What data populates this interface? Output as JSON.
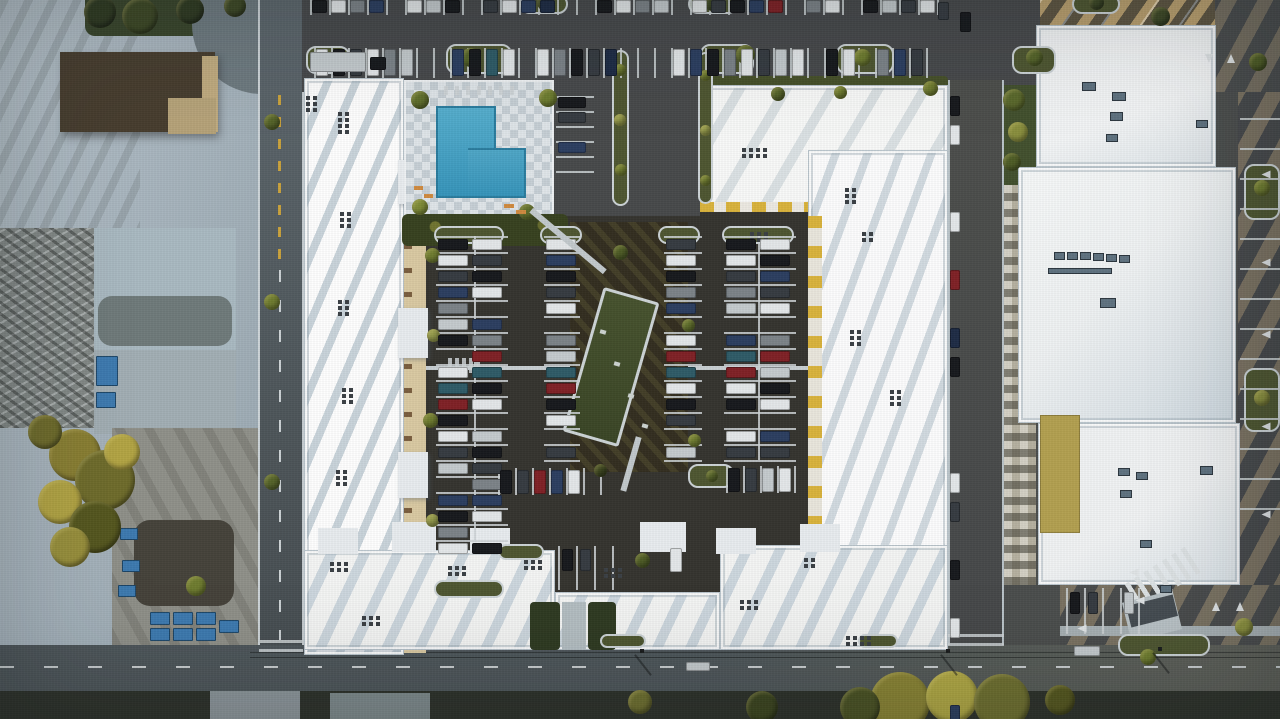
{
  "meta": {
    "description": "Top-down aerial drone photograph at golden hour: a large white-roofed apartment complex surrounding an interior courtyard parking lot full of cars, with a swimming pool and checkerboard deck at the upper left of the courtyard, a white commercial building to the east, industrial gray buildings and dirt lots to the west, and streets with long palm-tree shadows on the right and bottom edges.",
    "scene_type": "aerial-photograph",
    "lighting": "low evening sun from the upper right, long diagonal shadows"
  },
  "palette": {
    "asphalt_lot": "#47494a",
    "asphalt_courtyard": "#35342f",
    "road": "#525a5f",
    "concrete": "#aeb9c1",
    "roof_white": "#e9edf0",
    "roof_shadow": "#cdd8e0",
    "sun_warm": "#d6b274",
    "pool_water": "#3f9ec3",
    "pool_deck": "#dfe5e9",
    "tree_olive": "#6f6c2c",
    "tree_yellow": "#b3a544",
    "hedge_dark": "#37411f",
    "yellow_accent": "#d9b33c",
    "mulch": "#332e20",
    "green_roof_structure": "#46522e",
    "dirt": "#8f9089",
    "dumpster_blue": "#3d7ab0",
    "stripe_white": "#ccd2d5"
  },
  "carColorKey": {
    "w": "#e3e7e9",
    "s": "#c4cacd",
    "k": "#17191d",
    "d": "#363b41",
    "g": "#7c8388",
    "b": "#2c3e60",
    "n": "#1e2c45",
    "t": "#2f5b67",
    "r": "#7f2126",
    "m": "#5f1c20"
  },
  "parkingRows": [
    {
      "name": "north-lot-row-upper",
      "x": 312,
      "y": 0,
      "dir": "h",
      "carW": 15,
      "carH": 13,
      "step": 19,
      "cars": "kwgb_wsk_dwbn__kwgs_wdkbr_gw_ksdw"
    },
    {
      "name": "north-lot-row-lower",
      "x": 316,
      "y": 49,
      "dir": "h",
      "carW": 12,
      "carH": 27,
      "step": 17,
      "cars": "wkdwgs__bktw_wgkdn___wbkgwdsw_kw_gbd"
    },
    {
      "name": "poolside-stalls",
      "x": 558,
      "y": 97,
      "dir": "v",
      "carW": 28,
      "carH": 11,
      "step": 15,
      "cars": "kd_b"
    },
    {
      "name": "courtyard-col1-west",
      "x": 438,
      "y": 239,
      "dir": "v",
      "carW": 30,
      "carH": 11,
      "step": 16,
      "cars": "kwdbgsk_wtrkwds_bkgw"
    },
    {
      "name": "courtyard-col1-east",
      "x": 472,
      "y": 239,
      "dir": "v",
      "carW": 30,
      "carH": 11,
      "step": 16,
      "cars": "wdkw_bgrtkw_skdgbw_k"
    },
    {
      "name": "courtyard-col2",
      "x": 546,
      "y": 239,
      "dir": "v",
      "carW": 30,
      "carH": 11,
      "step": 16,
      "cars": "wbkdw_gstrkw_d"
    },
    {
      "name": "courtyard-col3",
      "x": 666,
      "y": 239,
      "dir": "v",
      "carW": 30,
      "carH": 11,
      "step": 16,
      "cars": "dwkgb_wrtwkd_s"
    },
    {
      "name": "courtyard-col4-west",
      "x": 726,
      "y": 239,
      "dir": "v",
      "carW": 30,
      "carH": 11,
      "step": 16,
      "cars": "kwdgs_btrwk_wd"
    },
    {
      "name": "courtyard-col4-east",
      "x": 760,
      "y": 239,
      "dir": "v",
      "carW": 30,
      "carH": 11,
      "step": 16,
      "cars": "wkbdw_grskw_bd"
    },
    {
      "name": "courtyard-south-rowA",
      "x": 500,
      "y": 470,
      "dir": "h",
      "carW": 12,
      "carH": 24,
      "step": 17,
      "cars": "kdrbw_"
    },
    {
      "name": "courtyard-south-rowB",
      "x": 728,
      "y": 468,
      "dir": "h",
      "carW": 12,
      "carH": 24,
      "step": 17,
      "cars": "kdsw"
    },
    {
      "name": "courtyard-pocket",
      "x": 562,
      "y": 549,
      "dir": "h",
      "carW": 11,
      "carH": 22,
      "step": 18,
      "cars": "kd"
    },
    {
      "name": "street-parallel-parking",
      "x": 950,
      "y": 96,
      "dir": "v",
      "carW": 10,
      "carH": 20,
      "step": 29,
      "cars": "kw__w_r_nk___wd_k_w__b"
    },
    {
      "name": "south-building-stalls",
      "x": 1070,
      "y": 592,
      "dir": "h",
      "carW": 10,
      "carH": 22,
      "step": 18,
      "cars": "kd_s"
    }
  ],
  "singleCars": [
    {
      "x": 670,
      "y": 548,
      "w": 12,
      "h": 24,
      "c": "w"
    },
    {
      "x": 1074,
      "y": 646,
      "w": 26,
      "h": 10,
      "c": "s"
    },
    {
      "x": 686,
      "y": 662,
      "w": 24,
      "h": 9,
      "c": "s"
    },
    {
      "x": 310,
      "y": 52,
      "w": 56,
      "h": 20,
      "c": "s"
    },
    {
      "x": 370,
      "y": 57,
      "w": 16,
      "h": 13,
      "c": "k"
    },
    {
      "x": 960,
      "y": 12,
      "w": 11,
      "h": 20,
      "c": "k"
    },
    {
      "x": 938,
      "y": 2,
      "w": 11,
      "h": 18,
      "c": "d"
    }
  ],
  "islands": [
    [
      446,
      44,
      66,
      30
    ],
    [
      306,
      46,
      44,
      28
    ],
    [
      700,
      44,
      54,
      30
    ],
    [
      836,
      44,
      58,
      30
    ],
    [
      1012,
      46,
      44,
      28
    ],
    [
      520,
      -6,
      48,
      20
    ],
    [
      688,
      -6,
      50,
      20
    ],
    [
      1072,
      -6,
      48,
      20
    ],
    [
      434,
      226,
      70,
      18
    ],
    [
      434,
      580,
      70,
      18
    ],
    [
      540,
      226,
      42,
      18
    ],
    [
      658,
      226,
      42,
      18
    ],
    [
      722,
      226,
      72,
      18
    ],
    [
      498,
      544,
      46,
      16
    ],
    [
      688,
      464,
      46,
      24
    ],
    [
      1244,
      164,
      36,
      56
    ],
    [
      1244,
      368,
      36,
      64
    ],
    [
      1118,
      634,
      92,
      22
    ],
    [
      600,
      634,
      46,
      14
    ],
    [
      858,
      634,
      40,
      14
    ],
    [
      612,
      50,
      17,
      156
    ],
    [
      698,
      52,
      15,
      152
    ]
  ],
  "stripes": [
    {
      "x": 310,
      "y": 0,
      "w": 2,
      "h": 15,
      "count": 34,
      "dx": 19
    },
    {
      "x": 314,
      "y": 48,
      "w": 2,
      "h": 30,
      "count": 37,
      "dx": 17
    },
    {
      "x": 436,
      "y": 236,
      "w": 72,
      "h": 2,
      "count": 20,
      "dy": 16
    },
    {
      "x": 544,
      "y": 236,
      "w": 36,
      "h": 2,
      "count": 15,
      "dy": 16
    },
    {
      "x": 664,
      "y": 236,
      "w": 38,
      "h": 2,
      "count": 15,
      "dy": 16
    },
    {
      "x": 724,
      "y": 236,
      "w": 72,
      "h": 2,
      "count": 15,
      "dy": 16
    },
    {
      "x": 474,
      "y": 236,
      "w": 2,
      "h": 306
    },
    {
      "x": 758,
      "y": 236,
      "w": 2,
      "h": 224
    },
    {
      "x": 498,
      "y": 468,
      "w": 2,
      "h": 27,
      "count": 7,
      "dx": 17
    },
    {
      "x": 726,
      "y": 466,
      "w": 2,
      "h": 27,
      "count": 5,
      "dx": 17
    },
    {
      "x": 558,
      "y": 546,
      "w": 2,
      "h": 44,
      "count": 4,
      "dx": 18
    },
    {
      "x": 1066,
      "y": 588,
      "w": 2,
      "h": 46,
      "count": 5,
      "dx": 18
    },
    {
      "x": 1240,
      "y": 118,
      "w": 40,
      "h": 2,
      "count": 14,
      "dy": 30
    },
    {
      "x": 448,
      "y": 358,
      "w": 4,
      "h": 15,
      "count": 5,
      "dx": 7
    },
    {
      "x": 948,
      "y": 634,
      "w": 56,
      "h": 3,
      "count": 2,
      "dy": 9
    },
    {
      "x": 259,
      "y": 640,
      "w": 44,
      "h": 3,
      "count": 2,
      "dy": 9
    },
    {
      "x": 556,
      "y": 96,
      "w": 38,
      "h": 2,
      "count": 6,
      "dy": 15
    },
    {
      "x": 444,
      "y": 86,
      "w": 4,
      "h": 9,
      "count": 7,
      "dx": 11
    }
  ],
  "ventClusters": [
    [
      338,
      112,
      2,
      4
    ],
    [
      340,
      212,
      2,
      3
    ],
    [
      338,
      300,
      2,
      3
    ],
    [
      342,
      388,
      2,
      3
    ],
    [
      336,
      470,
      2,
      3
    ],
    [
      330,
      562,
      3,
      2
    ],
    [
      448,
      566,
      3,
      2
    ],
    [
      524,
      560,
      3,
      2
    ],
    [
      604,
      568,
      3,
      2
    ],
    [
      742,
      148,
      4,
      2
    ],
    [
      750,
      232,
      3,
      2
    ],
    [
      845,
      188,
      2,
      3
    ],
    [
      862,
      232,
      2,
      2
    ],
    [
      850,
      330,
      2,
      3
    ],
    [
      846,
      636,
      4,
      2
    ],
    [
      890,
      390,
      2,
      3
    ],
    [
      740,
      600,
      3,
      2
    ],
    [
      306,
      96,
      2,
      3
    ],
    [
      362,
      616,
      3,
      2
    ],
    [
      804,
      558,
      2,
      2
    ]
  ],
  "hvacUnits": [
    [
      1082,
      82,
      14,
      9
    ],
    [
      1112,
      92,
      14,
      9
    ],
    [
      1110,
      112,
      13,
      9
    ],
    [
      1106,
      134,
      12,
      8
    ],
    [
      1054,
      252,
      11,
      8
    ],
    [
      1067,
      252,
      11,
      8
    ],
    [
      1080,
      252,
      11,
      8
    ],
    [
      1093,
      253,
      11,
      8
    ],
    [
      1106,
      254,
      11,
      8
    ],
    [
      1119,
      255,
      11,
      8
    ],
    [
      1048,
      268,
      64,
      6
    ],
    [
      1100,
      298,
      16,
      10
    ],
    [
      1196,
      120,
      12,
      8
    ],
    [
      1118,
      468,
      12,
      8
    ],
    [
      1136,
      472,
      12,
      8
    ],
    [
      1120,
      490,
      12,
      8
    ],
    [
      1140,
      540,
      12,
      8
    ],
    [
      1200,
      466,
      13,
      9
    ],
    [
      1160,
      585,
      12,
      8
    ]
  ],
  "dumpsters": [
    [
      150,
      612,
      20,
      13
    ],
    [
      173,
      612,
      20,
      13
    ],
    [
      196,
      612,
      20,
      13
    ],
    [
      150,
      628,
      20,
      13
    ],
    [
      173,
      628,
      20,
      13
    ],
    [
      196,
      628,
      20,
      13
    ],
    [
      219,
      620,
      20,
      13
    ],
    [
      122,
      560,
      18,
      12
    ],
    [
      118,
      585,
      18,
      12
    ],
    [
      120,
      528,
      18,
      12
    ],
    [
      114,
      470,
      16,
      11
    ],
    [
      112,
      440,
      16,
      11
    ],
    [
      96,
      356,
      22,
      30
    ],
    [
      96,
      392,
      20,
      16
    ]
  ],
  "trees": [
    [
      75,
      455,
      52,
      "#8a7f33"
    ],
    [
      105,
      480,
      60,
      "#6f6c2c"
    ],
    [
      60,
      502,
      44,
      "#b3a544"
    ],
    [
      95,
      527,
      52,
      "#55571f"
    ],
    [
      70,
      547,
      40,
      "#99903c"
    ],
    [
      122,
      452,
      36,
      "#b3a544"
    ],
    [
      45,
      432,
      34,
      "#6f6c2c"
    ],
    [
      900,
      702,
      60,
      "#8a8434"
    ],
    [
      952,
      697,
      52,
      "#b0a844"
    ],
    [
      1002,
      702,
      56,
      "#6f7030"
    ],
    [
      860,
      707,
      40,
      "#4a5224"
    ],
    [
      762,
      707,
      32,
      "#3c451f"
    ],
    [
      640,
      702,
      24,
      "#6f7030"
    ],
    [
      1060,
      700,
      30,
      "#55571f"
    ],
    [
      100,
      12,
      32,
      "#2f3a22"
    ],
    [
      140,
      16,
      36,
      "#3d4826"
    ],
    [
      190,
      10,
      28,
      "#2f3a22"
    ],
    [
      235,
      6,
      22,
      "#3d4826"
    ],
    [
      420,
      100,
      18,
      "#5f6e2c"
    ],
    [
      548,
      98,
      18,
      "#6d7c30"
    ],
    [
      420,
      207,
      16,
      "#7d8a36"
    ],
    [
      527,
      212,
      16,
      "#5f6e2c"
    ],
    [
      432,
      255,
      15,
      "#6f7c30"
    ],
    [
      433,
      335,
      13,
      "#93994a"
    ],
    [
      430,
      420,
      15,
      "#6f7c30"
    ],
    [
      432,
      520,
      13,
      "#93994a"
    ],
    [
      688,
      325,
      13,
      "#5f6e2c"
    ],
    [
      694,
      440,
      13,
      "#6f7c30"
    ],
    [
      620,
      252,
      15,
      "#4e5c26"
    ],
    [
      642,
      560,
      15,
      "#4e5c26"
    ],
    [
      600,
      470,
      13,
      "#3c451f"
    ],
    [
      712,
      476,
      12,
      "#56642a"
    ],
    [
      470,
      57,
      19,
      "#56642a"
    ],
    [
      745,
      54,
      19,
      "#56642a"
    ],
    [
      862,
      57,
      17,
      "#6f7c30"
    ],
    [
      1034,
      57,
      17,
      "#56642a"
    ],
    [
      545,
      2,
      17,
      "#3d4826"
    ],
    [
      712,
      2,
      17,
      "#3d4826"
    ],
    [
      1096,
      2,
      15,
      "#3d4826"
    ],
    [
      620,
      70,
      12,
      "#6f7c30"
    ],
    [
      620,
      120,
      12,
      "#93994a"
    ],
    [
      621,
      170,
      12,
      "#6f7c30"
    ],
    [
      705,
      75,
      11,
      "#6f7c30"
    ],
    [
      705,
      130,
      11,
      "#93994a"
    ],
    [
      705,
      180,
      11,
      "#6f7c30"
    ],
    [
      1014,
      100,
      22,
      "#5a682c"
    ],
    [
      1018,
      132,
      20,
      "#8a8f3e"
    ],
    [
      1012,
      162,
      18,
      "#4e5c26"
    ],
    [
      1262,
      188,
      16,
      "#6f7c30"
    ],
    [
      1262,
      398,
      16,
      "#8a8f3e"
    ],
    [
      1160,
      16,
      19,
      "#3d4826"
    ],
    [
      1258,
      62,
      18,
      "#4e5c26"
    ],
    [
      1244,
      627,
      18,
      "#8a8f3e"
    ],
    [
      1148,
      657,
      16,
      "#6f7c30"
    ],
    [
      930,
      88,
      15,
      "#6f7c30"
    ],
    [
      272,
      122,
      16,
      "#56642a"
    ],
    [
      272,
      302,
      16,
      "#6f7c30"
    ],
    [
      272,
      482,
      16,
      "#56642a"
    ],
    [
      196,
      586,
      20,
      "#6f7c30"
    ],
    [
      778,
      94,
      14,
      "#56642a"
    ],
    [
      840,
      92,
      13,
      "#6f7c30"
    ]
  ],
  "accents": [
    [
      414,
      186,
      9,
      4,
      "#cf8a3f",
      0
    ],
    [
      424,
      194,
      9,
      4,
      "#cf8a3f",
      0
    ],
    [
      504,
      204,
      10,
      4,
      "#cf8a3f",
      0
    ],
    [
      516,
      210,
      10,
      4,
      "#cf8a3f",
      0
    ],
    [
      520,
      238,
      96,
      6,
      "#c2c9cc",
      40
    ],
    [
      628,
      436,
      6,
      56,
      "#c2c9cc",
      16
    ],
    [
      600,
      330,
      6,
      4,
      "#cdd3d0",
      16
    ],
    [
      614,
      362,
      6,
      4,
      "#cdd3d0",
      16
    ],
    [
      628,
      394,
      6,
      4,
      "#cdd3d0",
      16
    ],
    [
      642,
      424,
      6,
      4,
      "#cdd3d0",
      16
    ],
    [
      642,
      652,
      2,
      26,
      "rgba(22,24,24,.5)",
      -38
    ],
    [
      948,
      652,
      2,
      26,
      "rgba(22,24,24,.5)",
      -38
    ],
    [
      1160,
      650,
      2,
      26,
      "rgba(22,24,24,.5)",
      -38
    ],
    [
      640,
      649,
      4,
      4,
      "#1b1d1d",
      0
    ],
    [
      946,
      649,
      4,
      4,
      "#1b1d1d",
      0
    ],
    [
      1158,
      647,
      4,
      4,
      "#1b1d1d",
      0
    ]
  ],
  "arrows": [
    [
      1205,
      54,
      180
    ],
    [
      1227,
      54,
      0
    ],
    [
      1262,
      170,
      270
    ],
    [
      1262,
      258,
      270
    ],
    [
      1262,
      330,
      270
    ],
    [
      1262,
      422,
      270
    ],
    [
      1262,
      510,
      270
    ],
    [
      1130,
      568,
      270
    ],
    [
      1136,
      596,
      270
    ],
    [
      1078,
      624,
      270
    ],
    [
      1212,
      602,
      0
    ],
    [
      1236,
      602,
      0
    ]
  ]
}
